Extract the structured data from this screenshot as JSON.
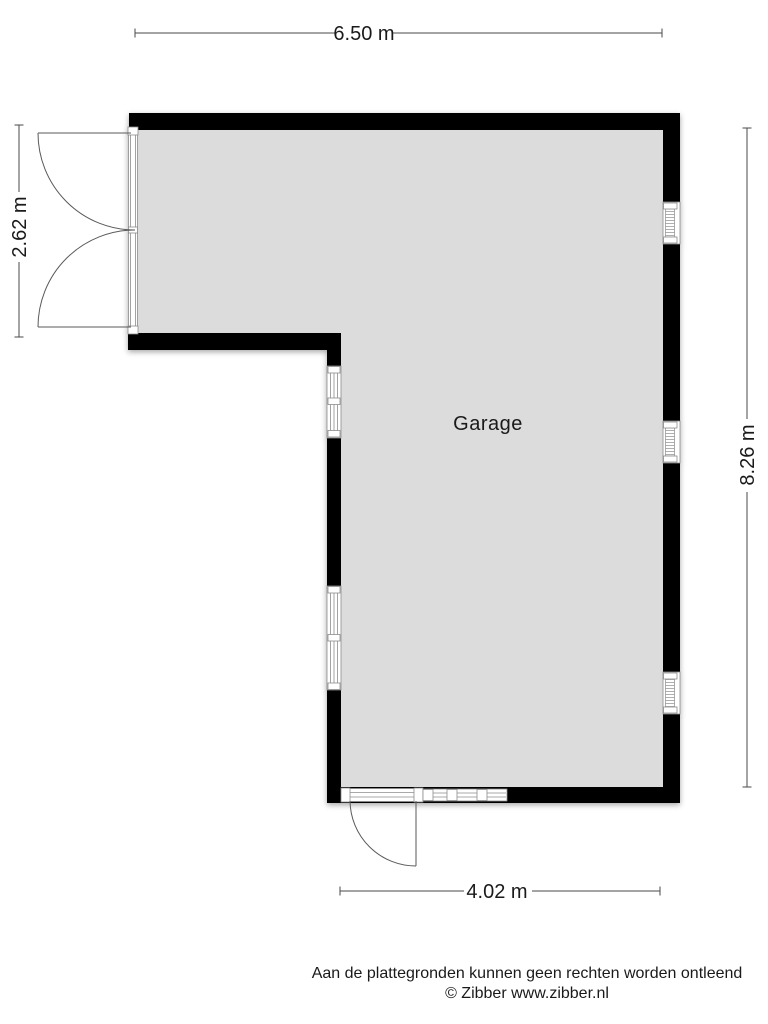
{
  "plan": {
    "room_label": "Garage",
    "dimensions": {
      "top": "6.50 m",
      "left": "2.62 m",
      "right": "8.26 m",
      "bottom": "4.02 m"
    },
    "features": {
      "windows_right_wall": 3,
      "windows_left_lower_wall": 2,
      "windows_bottom_wall": 1,
      "double_door_left": true,
      "single_door_bottom": true
    }
  },
  "footer": {
    "disclaimer": "Aan de plattegronden kunnen geen rechten worden ontleend",
    "copyright": "© Zibber www.zibber.nl"
  },
  "colors": {
    "wall": "#000000",
    "floor": "#dcdcdc",
    "dim-line": "#4a4a4a",
    "frame-line": "#8c8c8c",
    "text": "#1a1a1a",
    "background": "#ffffff"
  }
}
